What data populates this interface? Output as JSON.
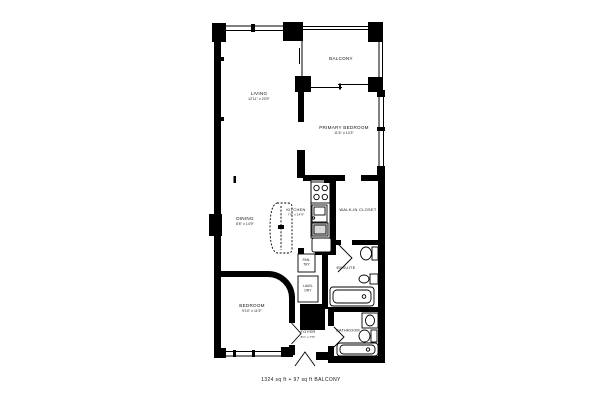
{
  "page": {
    "background": "#ffffff"
  },
  "plan": {
    "caption": "1324 sq ft + 97 sq ft BALCONY",
    "wall_color": "#000000",
    "rooms": {
      "living": {
        "name": "LIVING",
        "dims": "12'11\" x 23'9\""
      },
      "balcony": {
        "name": "BALCONY"
      },
      "primary_bedroom": {
        "name": "PRIMARY BEDROOM",
        "dims": "11'6\" x 14'3\""
      },
      "kitchen": {
        "name": "KITCHEN",
        "dims": "7'6\" x 14'9\""
      },
      "dining": {
        "name": "DINING",
        "dims": "8'5\" x 14'9\""
      },
      "walk_in_closet": {
        "name": "WALK-IN CLOSET"
      },
      "ensuite": {
        "name": "ENSUITE"
      },
      "pantry": {
        "line1": "PAN-",
        "line2": "TRY"
      },
      "laundry": {
        "line1": "LAUN-",
        "line2": "DRY"
      },
      "bedroom": {
        "name": "BEDROOM",
        "dims": "9'10\" x 11'9\""
      },
      "foyer": {
        "name": "FOYER",
        "dims": "8'1\" x 7'5\""
      },
      "bathroom": {
        "name": "BATHROOM"
      }
    }
  }
}
